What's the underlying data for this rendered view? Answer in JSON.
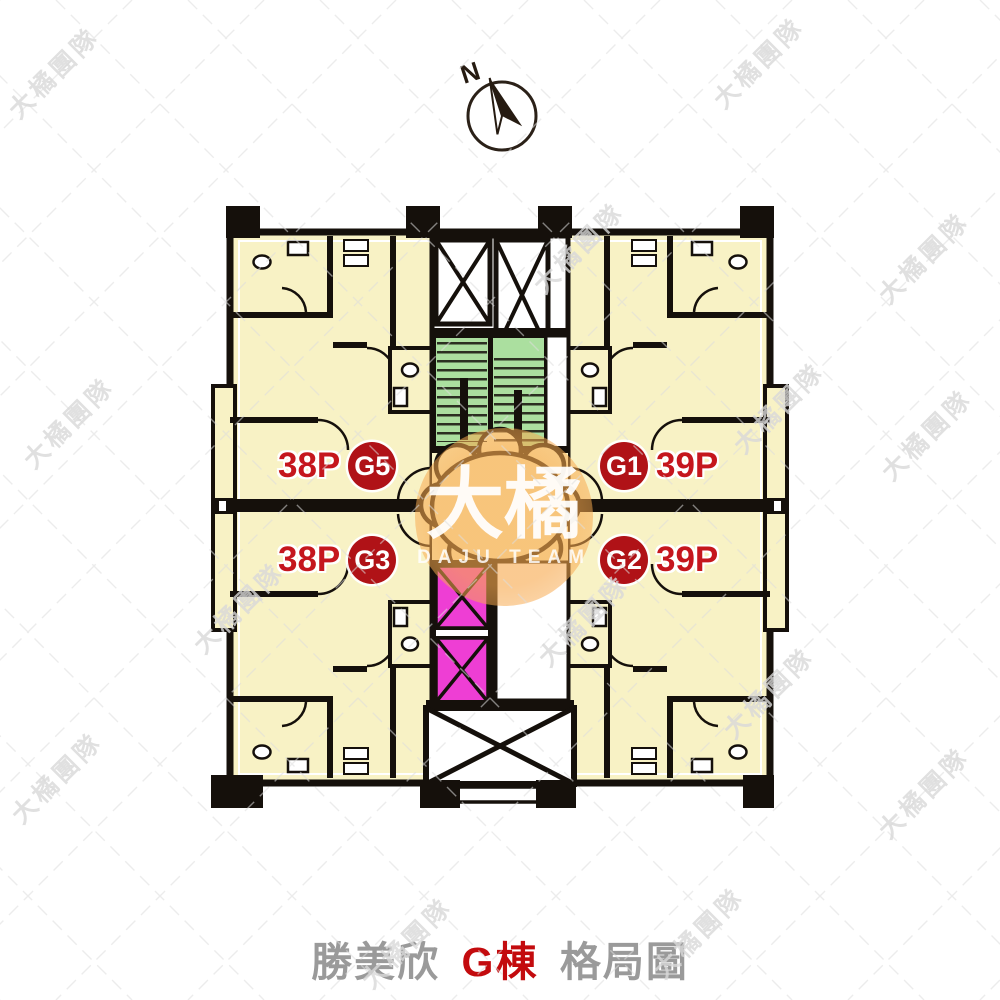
{
  "compass": {
    "label": "N"
  },
  "watermark": {
    "tile_text": "大橘團隊",
    "center_title": "大橘",
    "center_subtitle": "DAJU TEAM"
  },
  "units": [
    {
      "id": "G5",
      "size": "38P",
      "position": "top-left"
    },
    {
      "id": "G1",
      "size": "39P",
      "position": "top-right"
    },
    {
      "id": "G3",
      "size": "38P",
      "position": "bottom-left"
    },
    {
      "id": "G2",
      "size": "39P",
      "position": "bottom-right"
    }
  ],
  "title": {
    "project": "勝美欣",
    "building": "G棟",
    "suffix": "格局圖"
  },
  "colors": {
    "room_fill": "#f8f2c5",
    "wall": "#15100b",
    "stair_fill": "#abdf9f",
    "elevator_fill": "#ee3ed4",
    "label_text": "#c5161d",
    "badge_fill": "#b01217",
    "badge_text": "#ffffff",
    "title_text": "#9a9a9a",
    "title_accent": "#c30b0e",
    "watermark_orange": "#f7aa50"
  }
}
